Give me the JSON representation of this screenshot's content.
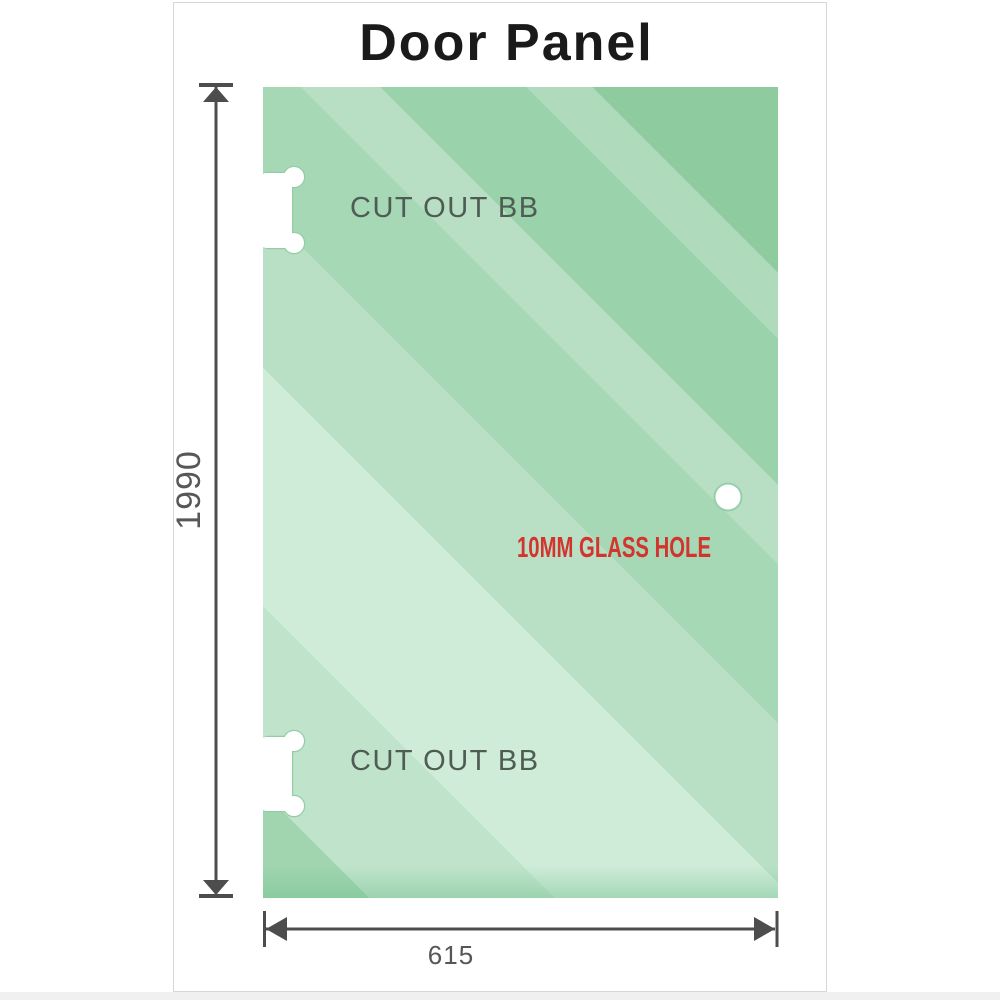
{
  "diagram": {
    "title": "Door Panel",
    "dimensions": {
      "height": {
        "value": "1990",
        "orientation": "vertical"
      },
      "width": {
        "value": "615",
        "orientation": "horizontal"
      }
    },
    "cutouts": [
      {
        "label": "CUT OUT BB",
        "position": "top-left-edge"
      },
      {
        "label": "CUT OUT BB",
        "position": "bottom-left-edge"
      }
    ],
    "hole": {
      "label": "10MM GLASS HOLE"
    },
    "colors": {
      "glass_green_dark": "#8ecc9f",
      "glass_green_light": "#cfecd8",
      "cutout_outline_green": "#93cda6",
      "dimension_gray": "#4d4d4d",
      "dimension_label_gray": "#575757",
      "cutout_label_gray": "#4e5c54",
      "hole_label_red": "#d2342e",
      "title_black": "#1a1a1a",
      "card_border": "#d6d6d6"
    }
  }
}
